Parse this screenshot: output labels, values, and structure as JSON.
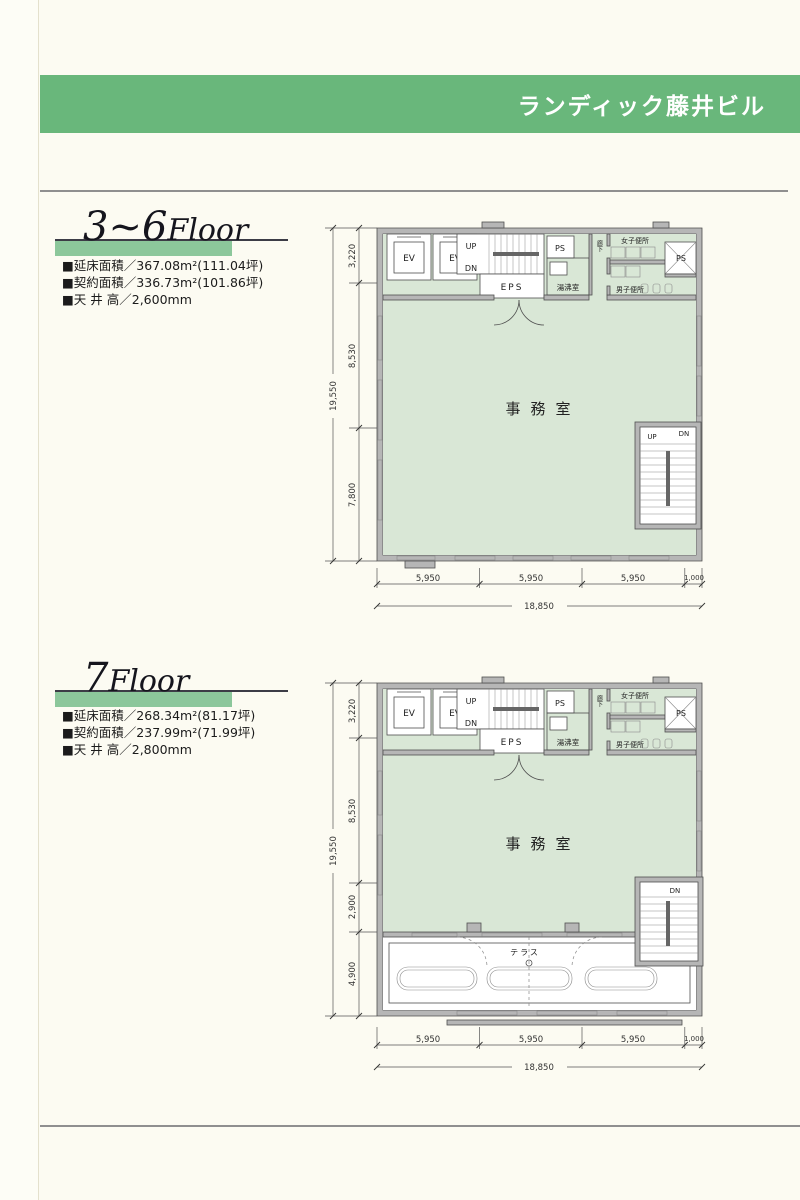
{
  "header": {
    "building_name": "ランディック藤井ビル"
  },
  "colors": {
    "banner_green": "#69b77b",
    "plan_fill_green": "#d9e7d6",
    "title_bar_green": "#8cc79b"
  },
  "sections": [
    {
      "title_num": "3~6",
      "title_word": "Floor",
      "specs": [
        "■延床面積／367.08m²(111.04坪)",
        "■契約面積／336.73m²(101.86坪)",
        "■天 井 高／2,600mm"
      ],
      "plan": {
        "labels": {
          "ev1": "EV",
          "ev2": "EV",
          "stair_up": "UP",
          "stair_dn": "DN",
          "eps": "EPS",
          "ps1": "PS",
          "kitchen": "湯沸室",
          "corridor": "廊下",
          "womens": "女子便所",
          "ps2": "PS",
          "mens": "男子便所",
          "office": "事務室",
          "stair2_up": "UP",
          "stair2_dn": "DN"
        },
        "dims_left": {
          "total": "19,550",
          "segments": [
            "3,220",
            "8,530",
            "7,800"
          ]
        },
        "dims_bottom": {
          "total": "18,850",
          "segments": [
            "5,950",
            "5,950",
            "5,950",
            "1,000"
          ]
        }
      }
    },
    {
      "title_num": "7",
      "title_word": "Floor",
      "specs": [
        "■延床面積／268.34m²(81.17坪)",
        "■契約面積／237.99m²(71.99坪)",
        "■天 井 高／2,800mm"
      ],
      "plan": {
        "labels": {
          "ev1": "EV",
          "ev2": "EV",
          "stair_up": "UP",
          "stair_dn": "DN",
          "eps": "EPS",
          "ps1": "PS",
          "kitchen": "湯沸室",
          "corridor": "廊下",
          "womens": "女子便所",
          "ps2": "PS",
          "mens": "男子便所",
          "office": "事務室",
          "terrace": "テラス",
          "stair2_dn": "DN"
        },
        "dims_left": {
          "total": "19,550",
          "segments": [
            "3,220",
            "8,530",
            "2,900",
            "4,900"
          ]
        },
        "dims_bottom": {
          "total": "18,850",
          "segments": [
            "5,950",
            "5,950",
            "5,950",
            "1,000"
          ]
        }
      }
    }
  ]
}
